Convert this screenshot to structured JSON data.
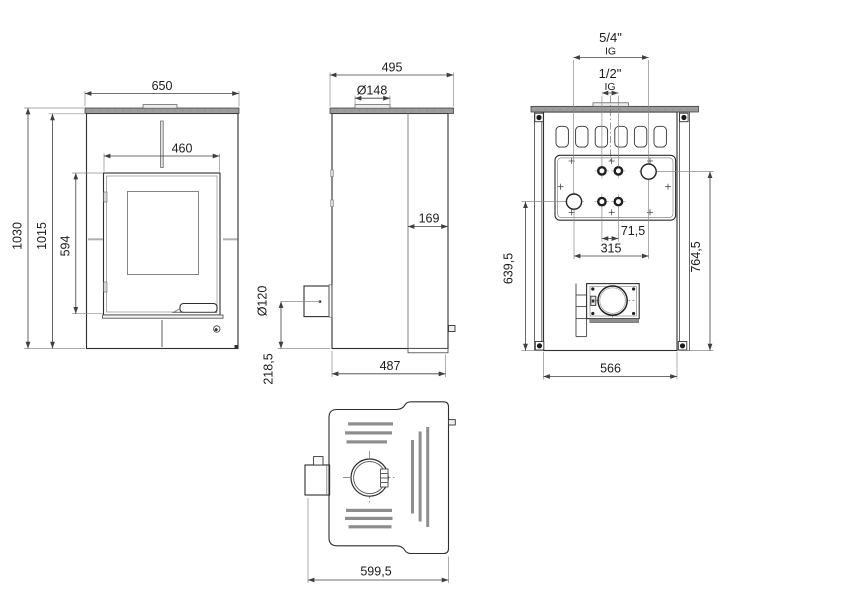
{
  "page": {
    "background": "#ffffff",
    "description": "technical drawing, four orthographic views of a stove with dimensions"
  },
  "colors": {
    "line": "#2e2e2e",
    "plate": "#9c9c9c",
    "dim": "#3f3f3f",
    "ext": "#8c8c8c",
    "center": "#6e6e6e",
    "text": "#1c1c1c",
    "bar": "#8e8e8e"
  },
  "views": {
    "front": {
      "dims": {
        "top_width": "650",
        "door_width": "460",
        "total_height": "1030",
        "body_height": "1015",
        "door_height": "594"
      }
    },
    "side": {
      "dims": {
        "top_depth": "495",
        "flue_diameter": "Ø148",
        "front_section_depth": "169",
        "rear_outlet_diameter": "Ø120",
        "rear_outlet_height": "218,5",
        "base_depth": "487"
      }
    },
    "rear": {
      "dims": {
        "large_fitting_size": "5/4\"",
        "large_fitting_thread": "IG",
        "small_fitting_size": "1/2\"",
        "small_fitting_thread": "IG",
        "small_fitting_spacing": "71,5",
        "large_fitting_spacing": "315",
        "left_fitting_height": "639,5",
        "right_fitting_height": "764,5",
        "base_width": "566"
      }
    },
    "top": {
      "dims": {
        "total_depth": "599,5"
      }
    }
  }
}
